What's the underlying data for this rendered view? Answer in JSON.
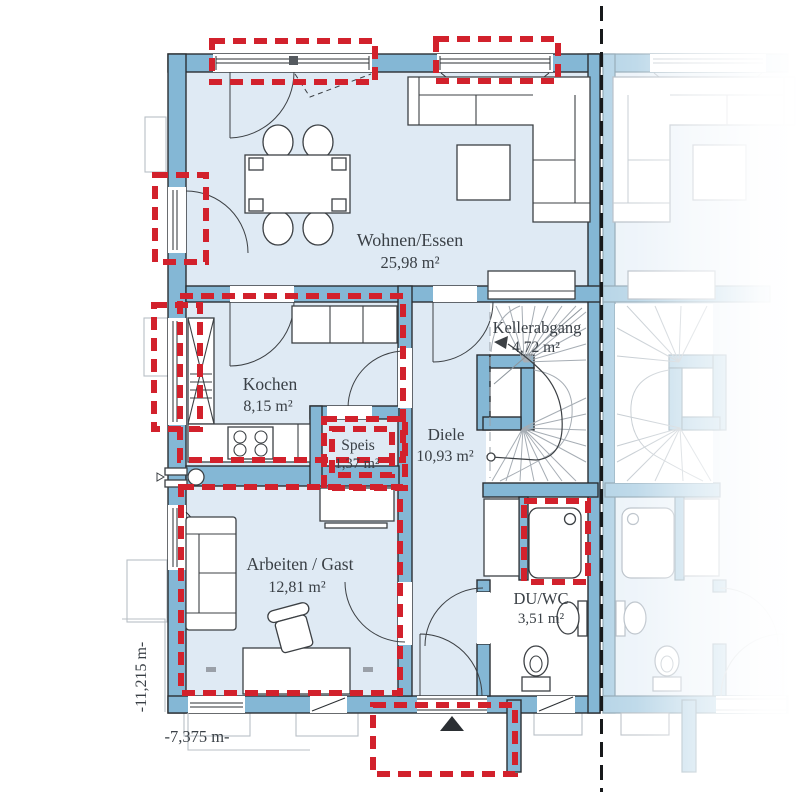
{
  "plan": {
    "title": "Erdgeschoss Grundriss (Doppelhaushälfte)",
    "rooms": {
      "wohnen": {
        "name": "Wohnen/Essen",
        "area": "25,98 m²"
      },
      "kochen": {
        "name": "Kochen",
        "area": "8,15 m²"
      },
      "speis": {
        "name": "Speis",
        "area": "1,37 m²"
      },
      "diele": {
        "name": "Diele",
        "area": "10,93 m²"
      },
      "kellerabgang": {
        "name": "Kellerabgang",
        "area": "4,72 m²"
      },
      "arbeiten": {
        "name": "Arbeiten / Gast",
        "area": "12,81 m²"
      },
      "duwc": {
        "name": "DU/WC",
        "area": "3,51 m²"
      }
    },
    "dims": {
      "depth": "-11,215 m-",
      "width": "-7,375 m-"
    },
    "colors": {
      "wall": "#84b7d5",
      "floor": "#dfeaf4",
      "highlight_red": "#d2212c",
      "boundary_black": "#17191b",
      "faded_wall": "#b7d5e7",
      "text": "#3a4046"
    }
  }
}
